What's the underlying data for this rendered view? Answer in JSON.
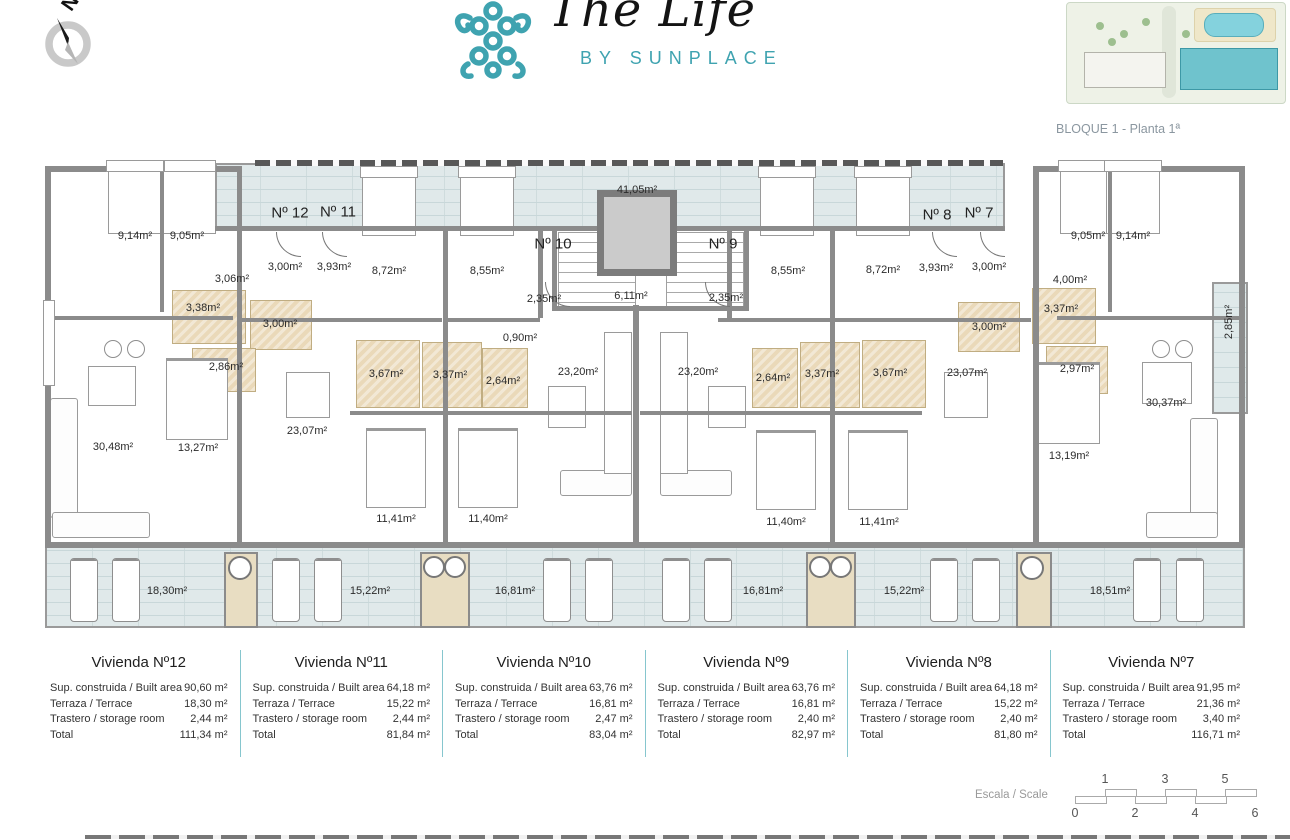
{
  "header": {
    "compass": {
      "label": "N"
    },
    "logo": {
      "title": "The Life",
      "subtitle": "BY SUNPLACE",
      "accent": "#3fa3b0"
    },
    "siteplan_caption": "BLOQUE 1 - Planta 1ª"
  },
  "plan": {
    "unit_labels": [
      {
        "text": "Nº 12",
        "x": 290,
        "y": 213
      },
      {
        "text": "Nº 11",
        "x": 338,
        "y": 212
      },
      {
        "text": "Nº 10",
        "x": 553,
        "y": 244
      },
      {
        "text": "Nº 9",
        "x": 723,
        "y": 244
      },
      {
        "text": "Nº 8",
        "x": 937,
        "y": 215
      },
      {
        "text": "Nº 7",
        "x": 979,
        "y": 213
      }
    ],
    "room_labels": [
      {
        "text": "41,05m²",
        "x": 637,
        "y": 190
      },
      {
        "text": "9,14m²",
        "x": 135,
        "y": 236
      },
      {
        "text": "9,05m²",
        "x": 187,
        "y": 236
      },
      {
        "text": "3,06m²",
        "x": 232,
        "y": 279
      },
      {
        "text": "3,00m²",
        "x": 285,
        "y": 267
      },
      {
        "text": "3,93m²",
        "x": 334,
        "y": 267
      },
      {
        "text": "3,38m²",
        "x": 203,
        "y": 308
      },
      {
        "text": "3,00m²",
        "x": 280,
        "y": 324
      },
      {
        "text": "2,86m²",
        "x": 226,
        "y": 367
      },
      {
        "text": "30,48m²",
        "x": 113,
        "y": 447
      },
      {
        "text": "13,27m²",
        "x": 198,
        "y": 448
      },
      {
        "text": "23,07m²",
        "x": 307,
        "y": 431
      },
      {
        "text": "8,72m²",
        "x": 389,
        "y": 271
      },
      {
        "text": "8,55m²",
        "x": 487,
        "y": 271
      },
      {
        "text": "3,67m²",
        "x": 386,
        "y": 374
      },
      {
        "text": "3,37m²",
        "x": 450,
        "y": 375
      },
      {
        "text": "2,64m²",
        "x": 503,
        "y": 381
      },
      {
        "text": "11,41m²",
        "x": 396,
        "y": 519
      },
      {
        "text": "11,40m²",
        "x": 488,
        "y": 519
      },
      {
        "text": "2,35m²",
        "x": 544,
        "y": 299
      },
      {
        "text": "0,90m²",
        "x": 520,
        "y": 338
      },
      {
        "text": "23,20m²",
        "x": 578,
        "y": 372
      },
      {
        "text": "6,11m²",
        "x": 631,
        "y": 296
      },
      {
        "text": "2,35m²",
        "x": 726,
        "y": 298
      },
      {
        "text": "23,20m²",
        "x": 698,
        "y": 372
      },
      {
        "text": "8,55m²",
        "x": 788,
        "y": 271
      },
      {
        "text": "8,72m²",
        "x": 883,
        "y": 270
      },
      {
        "text": "2,64m²",
        "x": 773,
        "y": 378
      },
      {
        "text": "3,37m²",
        "x": 822,
        "y": 374
      },
      {
        "text": "3,67m²",
        "x": 890,
        "y": 373
      },
      {
        "text": "11,40m²",
        "x": 786,
        "y": 522
      },
      {
        "text": "11,41m²",
        "x": 879,
        "y": 522
      },
      {
        "text": "3,93m²",
        "x": 936,
        "y": 268
      },
      {
        "text": "3,00m²",
        "x": 989,
        "y": 267
      },
      {
        "text": "3,00m²",
        "x": 989,
        "y": 327
      },
      {
        "text": "3,37m²",
        "x": 1061,
        "y": 309
      },
      {
        "text": "2,97m²",
        "x": 1077,
        "y": 369
      },
      {
        "text": "4,00m²",
        "x": 1070,
        "y": 280
      },
      {
        "text": "23,07m²",
        "x": 967,
        "y": 373
      },
      {
        "text": "13,19m²",
        "x": 1069,
        "y": 456
      },
      {
        "text": "9,05m²",
        "x": 1088,
        "y": 236
      },
      {
        "text": "9,14m²",
        "x": 1133,
        "y": 236
      },
      {
        "text": "30,37m²",
        "x": 1166,
        "y": 403
      },
      {
        "text": "2,85m²",
        "x": 1229,
        "y": 322,
        "rot": true
      }
    ],
    "terrace_labels": [
      {
        "text": "18,30m²",
        "x": 167,
        "y": 591
      },
      {
        "text": "15,22m²",
        "x": 370,
        "y": 591
      },
      {
        "text": "16,81m²",
        "x": 515,
        "y": 591
      },
      {
        "text": "16,81m²",
        "x": 763,
        "y": 591
      },
      {
        "text": "15,22m²",
        "x": 904,
        "y": 591
      },
      {
        "text": "18,51m²",
        "x": 1110,
        "y": 591
      }
    ]
  },
  "units": [
    {
      "title": "Vivienda Nº12",
      "rows": [
        {
          "label": "Sup. construida / Built area",
          "value": "90,60 m²"
        },
        {
          "label": "Terraza / Terrace",
          "value": "18,30 m²"
        },
        {
          "label": "Trastero / storage room",
          "value": "2,44 m²"
        },
        {
          "label": "Total",
          "value": "111,34 m²"
        }
      ]
    },
    {
      "title": "Vivienda Nº11",
      "rows": [
        {
          "label": "Sup. construida / Built area",
          "value": "64,18 m²"
        },
        {
          "label": "Terraza / Terrace",
          "value": "15,22 m²"
        },
        {
          "label": "Trastero / storage room",
          "value": "2,44 m²"
        },
        {
          "label": "Total",
          "value": "81,84 m²"
        }
      ]
    },
    {
      "title": "Vivienda Nº10",
      "rows": [
        {
          "label": "Sup. construida / Built area",
          "value": "63,76 m²"
        },
        {
          "label": "Terraza / Terrace",
          "value": "16,81 m²"
        },
        {
          "label": "Trastero / storage room",
          "value": "2,47 m²"
        },
        {
          "label": "Total",
          "value": "83,04 m²"
        }
      ]
    },
    {
      "title": "Vivienda Nº9",
      "rows": [
        {
          "label": "Sup. construida / Built area",
          "value": "63,76 m²"
        },
        {
          "label": "Terraza / Terrace",
          "value": "16,81 m²"
        },
        {
          "label": "Trastero / storage room",
          "value": "2,40 m²"
        },
        {
          "label": "Total",
          "value": "82,97 m²"
        }
      ]
    },
    {
      "title": "Vivienda Nº8",
      "rows": [
        {
          "label": "Sup. construida / Built area",
          "value": "64,18 m²"
        },
        {
          "label": "Terraza / Terrace",
          "value": "15,22 m²"
        },
        {
          "label": "Trastero / storage room",
          "value": "2,40 m²"
        },
        {
          "label": "Total",
          "value": "81,80 m²"
        }
      ]
    },
    {
      "title": "Vivienda Nº7",
      "rows": [
        {
          "label": "Sup. construida / Built area",
          "value": "91,95 m²"
        },
        {
          "label": "Terraza / Terrace",
          "value": "21,36 m²"
        },
        {
          "label": "Trastero / storage room",
          "value": "3,40 m²"
        },
        {
          "label": "Total",
          "value": "116,71 m²"
        }
      ]
    }
  ],
  "scale_bar": {
    "label": "Escala / Scale",
    "top_ticks": [
      "1",
      "3",
      "5"
    ],
    "bottom_ticks": [
      "0",
      "2",
      "4",
      "6"
    ]
  }
}
